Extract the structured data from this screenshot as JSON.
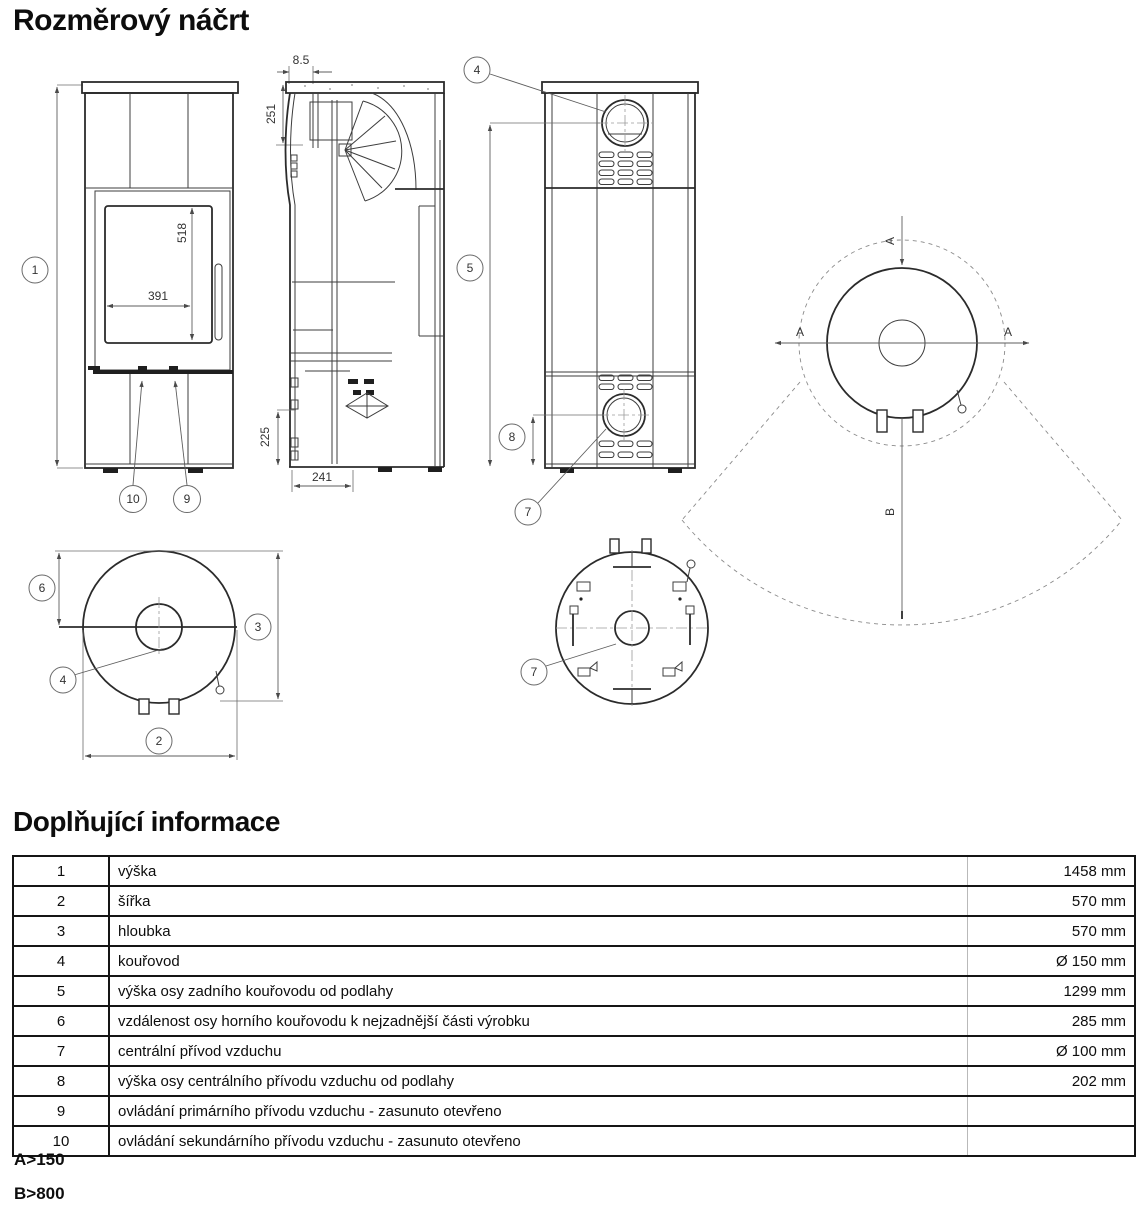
{
  "title": "Rozměrový náčrt",
  "info_heading": "Doplňující informace",
  "notes": {
    "a": "A>150",
    "b": "B>800"
  },
  "drawing": {
    "balloons": {
      "n1": "1",
      "n2": "2",
      "n3": "3",
      "n4": "4",
      "n5": "5",
      "n6": "6",
      "n7": "7",
      "n8": "8",
      "n9": "9",
      "n10": "10"
    },
    "dims": {
      "plate_offset": "8.5",
      "flue_depth": "251",
      "glass_height": "518",
      "glass_width": "391",
      "inlet_height": "225",
      "inlet_depth": "241"
    },
    "clearance": {
      "side_label": "A",
      "front_label": "B"
    }
  },
  "table": {
    "rows": [
      {
        "num": "1",
        "label": "výška",
        "value": "1458 mm"
      },
      {
        "num": "2",
        "label": "šířka",
        "value": "570 mm"
      },
      {
        "num": "3",
        "label": "hloubka",
        "value": "570 mm"
      },
      {
        "num": "4",
        "label": "kouřovod",
        "value": "Ø 150 mm"
      },
      {
        "num": "5",
        "label": "výška osy zadního kouřovodu od podlahy",
        "value": "1299 mm"
      },
      {
        "num": "6",
        "label": "vzdálenost osy horního kouřovodu k nejzadnější části výrobku",
        "value": "285 mm"
      },
      {
        "num": "7",
        "label": "centrální přívod vzduchu",
        "value": "Ø 100 mm"
      },
      {
        "num": "8",
        "label": "výška osy centrálního přívodu vzduchu od podlahy",
        "value": "202 mm"
      },
      {
        "num": "9",
        "label": "ovládání primárního přívodu vzduchu - zasunuto otevřeno",
        "value": ""
      },
      {
        "num": "10",
        "label": "ovládání sekundárního přívodu vzduchu - zasunuto otevřeno",
        "value": ""
      }
    ]
  }
}
